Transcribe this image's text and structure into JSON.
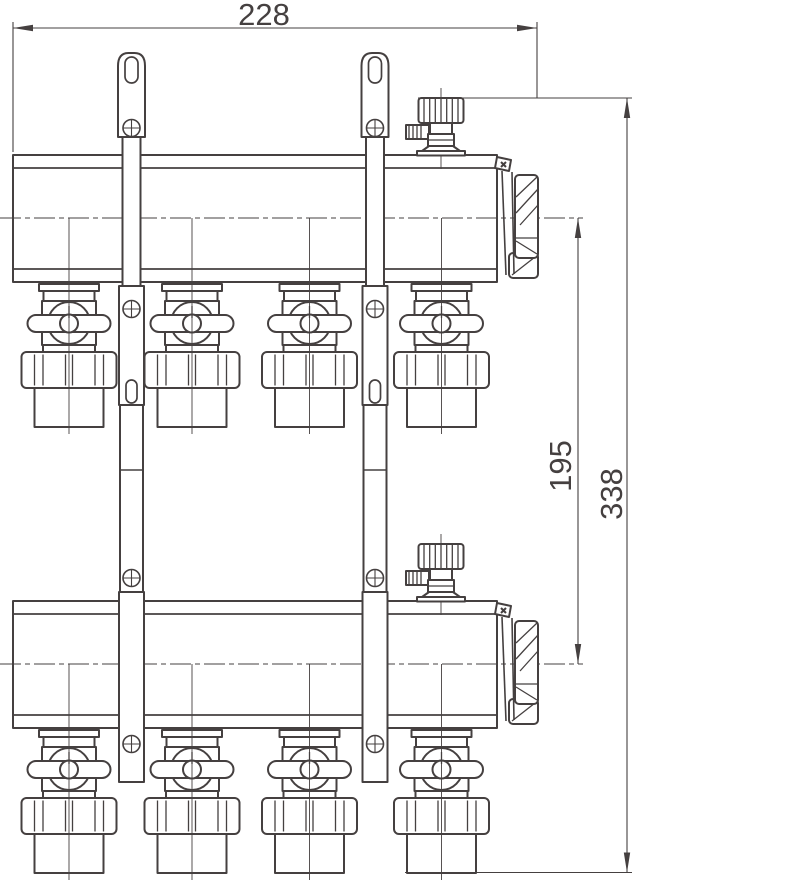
{
  "dimension_labels": {
    "manifold_length": "228",
    "manifold_center_distance": "195",
    "overall_height": "338"
  },
  "style": {
    "line_color": "#454040",
    "background_color": "#ffffff"
  },
  "structure": {
    "manifolds": 2,
    "outlet_valves_per_manifold": 4,
    "mounting_brackets": 2,
    "drain_valves": 2
  }
}
